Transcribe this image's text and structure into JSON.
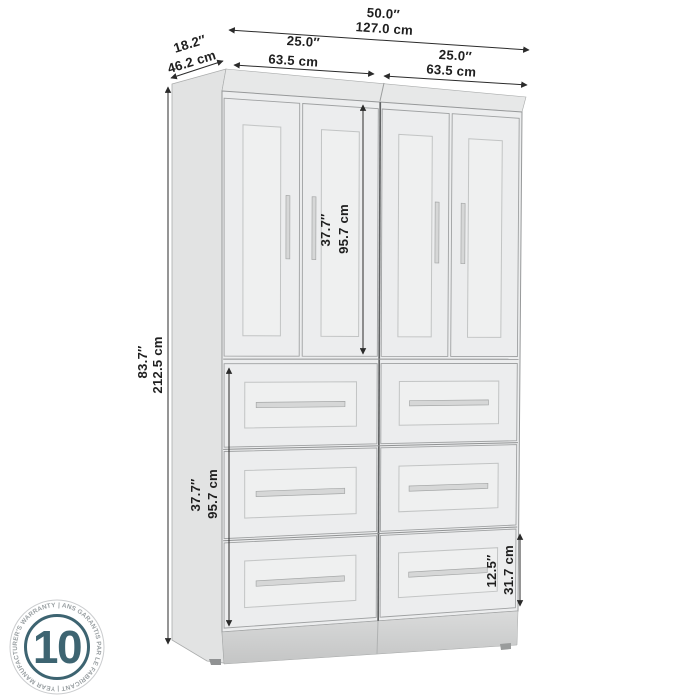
{
  "diagram": {
    "dimensions": {
      "total_width_in": "50.0″",
      "total_width_cm": "127.0 cm",
      "depth_in": "18.2″",
      "depth_cm": "46.2 cm",
      "left_section_in": "25.0″",
      "left_section_cm": "63.5 cm",
      "right_section_in": "25.0″",
      "right_section_cm": "63.5 cm",
      "total_height_in": "83.7″",
      "total_height_cm": "212.5 cm",
      "door_section_in": "37.7″",
      "door_section_cm": "95.7 cm",
      "drawer_section_in": "37.7″",
      "drawer_section_cm": "95.7 cm",
      "bottom_drawer_in": "12.5″",
      "bottom_drawer_cm": "31.7 cm"
    },
    "structure": {
      "door_columns": 2,
      "doors_per_column": 2,
      "drawer_columns": 2,
      "drawer_rows": 3
    },
    "colors": {
      "front": "#ecedee",
      "top": "#e7e8e8",
      "side": "#e2e3e3",
      "panel": "#eff0f0",
      "base_top": "#dadbdb",
      "base_bottom": "#c6c7c7",
      "seam": "#909293",
      "outline": "#9fa1a2",
      "handle": "#d6d7d7",
      "dim_line": "#2b2b2b"
    },
    "badge": {
      "value": "10",
      "ring_text": "|  ANS GARANTIS PAR LE FABRICANT  |  YEAR MANUFACTURER'S WARRANTY",
      "accent": "#3d6471",
      "ring_text_color": "#9aa0a3",
      "ring_circle_color": "#caccce"
    }
  }
}
